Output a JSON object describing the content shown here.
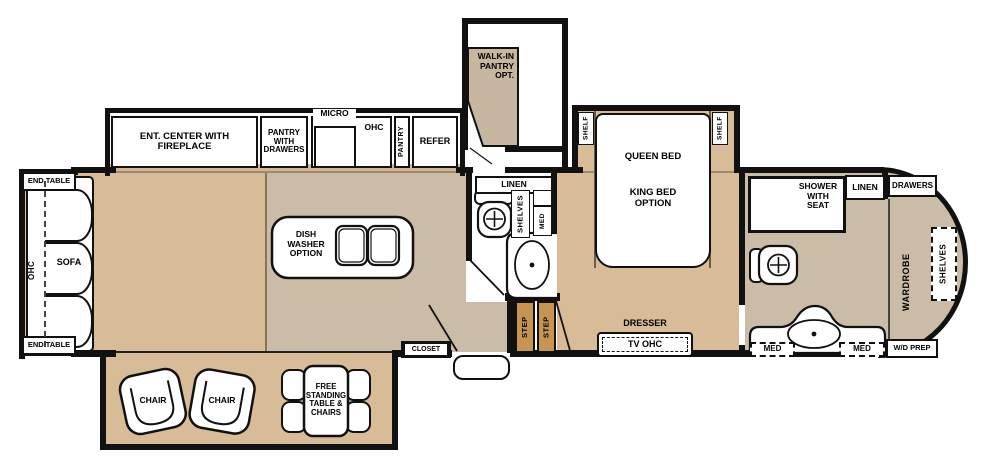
{
  "colors": {
    "wall": "#111111",
    "floor_tan": "#d8bc98",
    "floor_gray": "#cabca6",
    "step": "#c79551",
    "pantry_cabinet": "#c7b7a1"
  },
  "rear_slideout": {
    "end_table_top": "END TABLE",
    "ohc": "OHC",
    "sofa": "SOFA",
    "end_table_bottom": "END TABLE"
  },
  "kitchen_slideout": {
    "ent_center": "ENT. CENTER WITH\nFIREPLACE",
    "pantry_drawers": "PANTRY\nWITH\nDRAWERS",
    "micro": "MICRO",
    "ohc": "OHC",
    "pantry": "PANTRY",
    "refer": "REFER"
  },
  "kitchen": {
    "island": "DISH\nWASHER\nOPTION"
  },
  "walk_in_pantry": {
    "label": "WALK-IN\nPANTRY\nOPT."
  },
  "mid_bath": {
    "linen": "LINEN",
    "shelves": "SHELVES",
    "med": "MED"
  },
  "entry": {
    "closet": "CLOSET"
  },
  "bedroom": {
    "shelf_left": "SHELF",
    "shelf_right": "SHELF",
    "queen": "QUEEN BED",
    "king": "KING BED\nOPTION",
    "dresser": "DRESSER",
    "tv_ohc": "TV OHC",
    "step_1": "STEP",
    "step_2": "STEP"
  },
  "dinette_slideout": {
    "chair_1": "CHAIR",
    "chair_2": "CHAIR",
    "table": "FREE\nSTANDING\nTABLE &\nCHAIRS"
  },
  "master_bath": {
    "shower": "SHOWER\nWITH\nSEAT",
    "linen": "LINEN",
    "drawers": "DRAWERS",
    "med_left": "MED",
    "med_right": "MED",
    "wd_prep": "W/D PREP",
    "wardrobe": "WARDROBE",
    "shelves": "SHELVES"
  }
}
